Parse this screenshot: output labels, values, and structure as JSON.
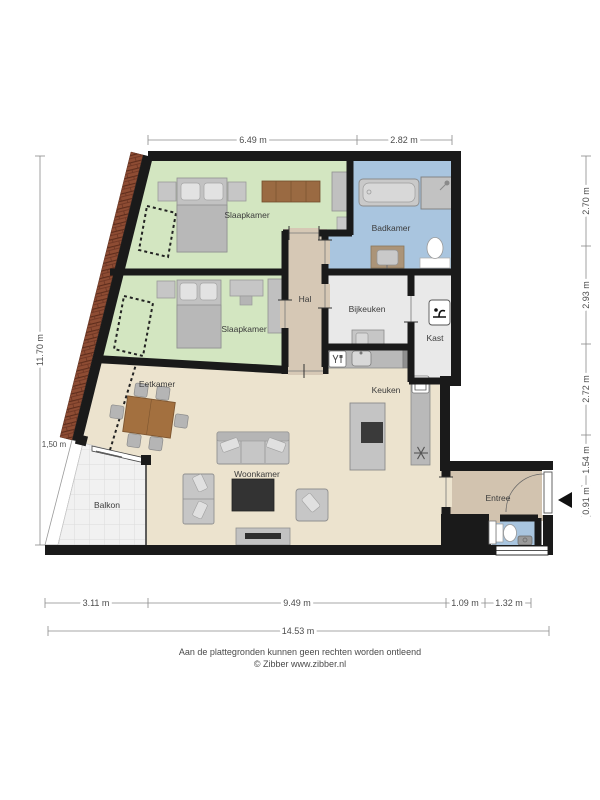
{
  "plan": {
    "rooms": {
      "slaapkamer_boven": "Slaapkamer",
      "slaapkamer_onder": "Slaapkamer",
      "badkamer": "Badkamer",
      "hal": "Hal",
      "bijkeuken": "Bijkeuken",
      "kast": "Kast",
      "keuken": "Keuken",
      "eetkamer": "Eetkamer",
      "woonkamer": "Woonkamer",
      "balkon": "Balkon",
      "entree": "Entree"
    }
  },
  "dimensions": {
    "top": [
      "6.49 m",
      "2.82 m"
    ],
    "right": [
      "2.70 m",
      "2.93 m",
      "2.72 m",
      "1.54 m",
      "0.91 m"
    ],
    "left_total": "11.70 m",
    "balkon_hoogte": "1,50 m",
    "bottom": [
      "3.11 m",
      "9.49 m",
      "1.09 m",
      "1.32 m"
    ],
    "bottom_total": "14.53 m"
  },
  "footer": {
    "disclaimer": "Aan de plattegronden kunnen geen rechten worden ontleend",
    "copyright": "© Zibber www.zibber.nl"
  },
  "icons": {
    "kast": "coat-hook",
    "oven": "oven",
    "koelkast": "snowflake",
    "vaatwasser": "glass-and-fork",
    "entree_richting": "left-arrow"
  },
  "colors": {
    "wall": "#1a1a1a",
    "slaapkamer": "#d3e6c1",
    "badkamer": "#a9c5df",
    "hal": "#d6c8b5",
    "bijkeuken_kast": "#e9e9e9",
    "woonruimte": "#ece3ce",
    "balkon": "#f1f1f1",
    "hout": "#9a6a42",
    "baksteen": "#8e4c33"
  }
}
